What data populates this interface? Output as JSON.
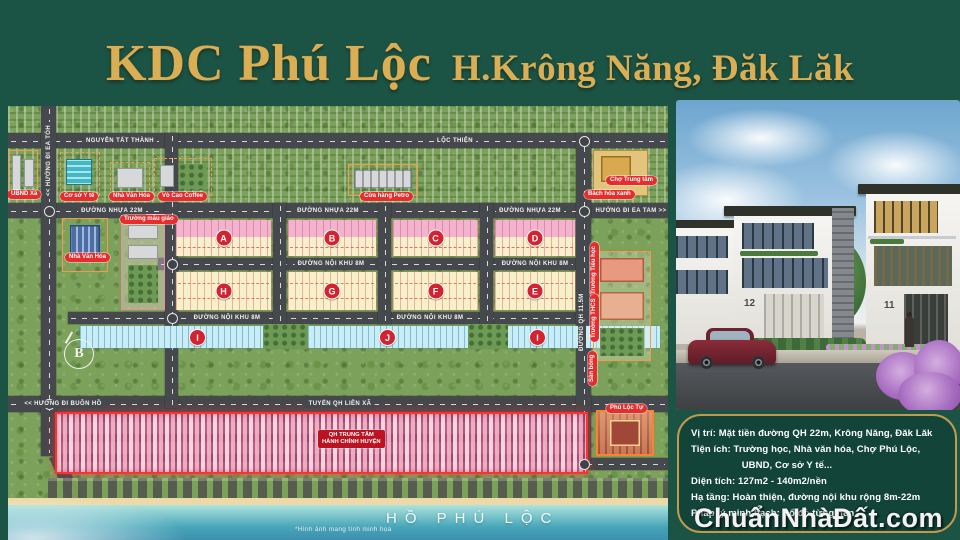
{
  "banner": {
    "title": "KDC Phú Lộc",
    "subtitle": "H.Krông Năng, Đăk Lăk"
  },
  "map": {
    "roads": {
      "nguyen_tat_thanh": "NGUYỄN TẤT THÀNH",
      "loc_thien": "LỘC THIỆN",
      "nhua_22m": "ĐƯỜNG NHỰA 22M",
      "ea_tam": "HƯỚNG ĐI EA TAM >>",
      "ea_toh": "<< HƯỚNG ĐI EA TÓH",
      "noi_khu_8m": "ĐƯỜNG NỘI KHU 8M",
      "tuyen_qh_lien_xa": "TUYẾN QH LIÊN XÃ",
      "buon_ho": "<< HƯỚNG ĐI BUÔN HỒ",
      "qh_115m": "ĐƯỜNG QH 11.5M"
    },
    "blocks": [
      "A",
      "B",
      "C",
      "D",
      "H",
      "G",
      "F",
      "E"
    ],
    "strip_blocks": [
      "I",
      "J",
      "I"
    ],
    "pois": {
      "ubnd": "UBND Xã",
      "y_te": "Cơ sở Y tế",
      "nha_van_hoa": "Nhà Văn Hóa",
      "coffee": "Vò Cao Coffee",
      "petro": "Cửa hàng Petro",
      "cho_trung_tam": "Chợ Trung tâm",
      "bach_hoa_xanh": "Bách hóa xanh",
      "mau_giao": "Trường mẫu giáo",
      "nha_van_hoa_2": "Nhà Văn Hóa",
      "tieu_hoc": "Trường Tiểu học",
      "thcs": "Trường THCS",
      "san_bong": "Sân bóng",
      "phu_loc_tu": "Phủ Lộc Tự",
      "admin_line1": "QH TRUNG TÂM",
      "admin_line2": "HÀNH CHÍNH HUYỆN"
    },
    "compass": "B",
    "lake_label": "HỒ PHÚ LỘC",
    "disclaimer": "*Hình ảnh mang tính minh họa"
  },
  "photo": {
    "house_number_left": "12",
    "house_number_right": "11"
  },
  "info_panel": {
    "lines": [
      "Vị trí: Mặt tiền đường QH 22m, Krông Năng, Đăk Lăk",
      "Tiện ích: Trường học, Nhà văn hóa, Chợ Phú Lộc,",
      "UBND, Cơ sở Y tế...",
      "Diện tích: 127m2 - 140m2/nền",
      "Hạ tầng: Hoàn thiện, đường nội khu rộng 8m-22m",
      "Pháp lý minh bạch: Sổ đỏ từng nền"
    ]
  },
  "watermark": "ChuẩnNhàĐất.com",
  "colors": {
    "background": "#1b5345",
    "gold": "#d9ae54",
    "road": "#45484c",
    "pill_red": "#e82c2c",
    "lot_pink": "#f2b4cc",
    "lot_cream": "#f8f0ca",
    "lot_cyan": "#c9edf6",
    "zone_red": "#ff3030",
    "lake": "#45a4b8"
  }
}
